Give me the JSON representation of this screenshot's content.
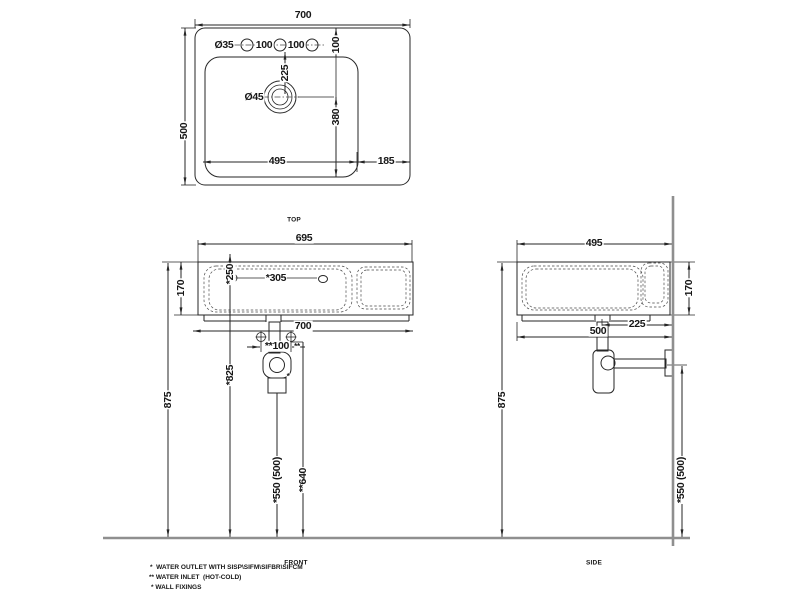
{
  "views": {
    "top": {
      "label": "TOP",
      "dims": {
        "overall_width": "700",
        "overall_depth": "500",
        "tap_hole_dia": "Ø35",
        "tap_hole_spacing_1": "100",
        "tap_hole_spacing_2": "100",
        "tap_hole_edge_offset": "100",
        "drain_offset": "225",
        "drain_dia": "Ø45",
        "drain_to_front": "380",
        "bowl_width": "495",
        "deck_width": "185"
      }
    },
    "front": {
      "label": "FRONT",
      "dims": {
        "rim_width": "695",
        "bowl_height": "170",
        "overall_height": "875",
        "fixing_offset": "*250",
        "fixing_height": "*825",
        "outlet_offset": "*305",
        "overall_width": "700",
        "inlet_spacing": "**100",
        "inlet_mark": "**",
        "outlet_mark": "*",
        "outlet_height": "*550 (500)",
        "inlet_height": "**640"
      }
    },
    "side": {
      "label": "SIDE",
      "dims": {
        "overall_depth": "495",
        "bowl_height": "170",
        "drain_to_wall": "225",
        "depth_total": "500",
        "overall_height": "875",
        "outlet_height": "*550 (500)"
      }
    }
  },
  "footnotes": [
    "*  WATER OUTLET WITH SISP\\SIFM\\SIFBR\\SIFCM",
    "** WATER INLET  (HOT-COLD)",
    "* WALL FIXINGS"
  ],
  "colors": {
    "line": "#262626",
    "wall_floor": "#8f8f8f",
    "background": "#ffffff"
  }
}
